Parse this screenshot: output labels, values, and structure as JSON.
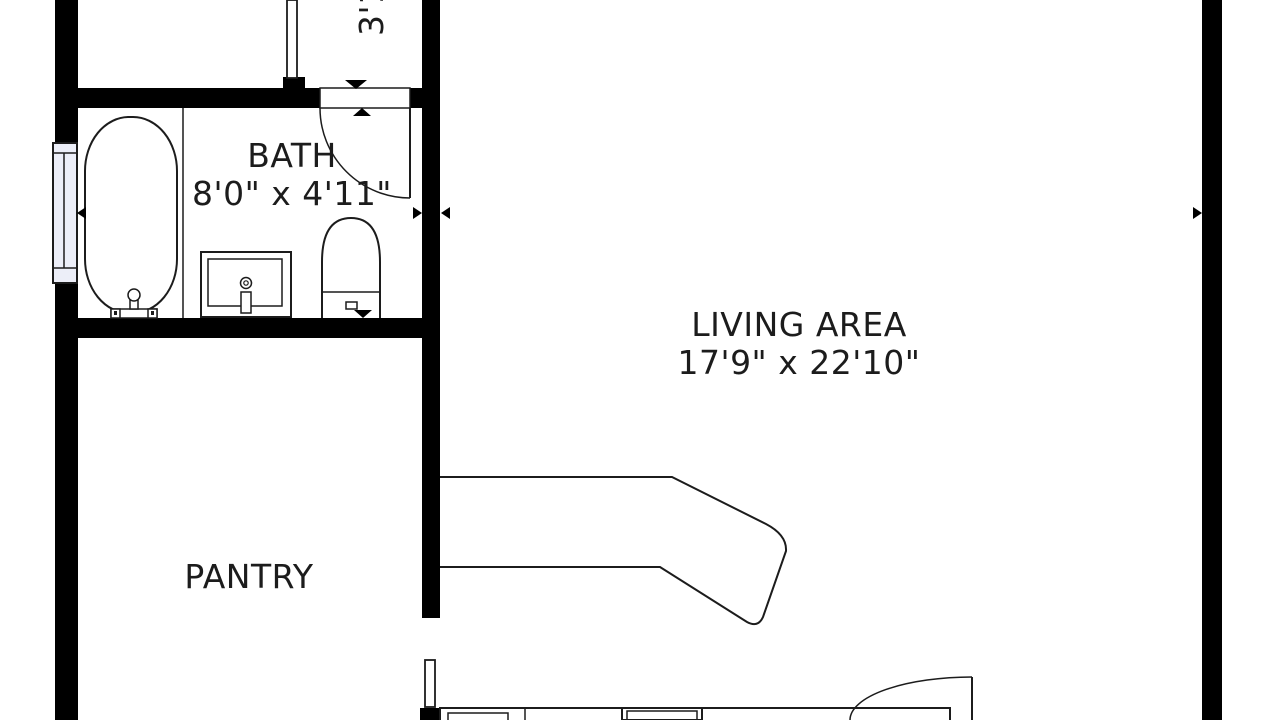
{
  "colors": {
    "wall": "#000000",
    "line": "#1c1c1c",
    "text": "#1c1c1c",
    "background": "#ffffff",
    "window_fill": "#eceef8"
  },
  "rooms": [
    {
      "id": "bath",
      "name": "BATH",
      "dimensions": "8'0\" x 4'11\""
    },
    {
      "id": "living-area",
      "name": "LIVING AREA",
      "dimensions": "17'9\" x 22'10\""
    },
    {
      "id": "pantry",
      "name": "PANTRY",
      "dimensions": ""
    },
    {
      "id": "hallway",
      "name": "",
      "dimensions": "3'1"
    }
  ],
  "fixtures": [
    "bathtub",
    "tub-faucet",
    "vanity-sink",
    "sink-faucet",
    "toilet",
    "bath-window",
    "bath-door",
    "hall-door",
    "pantry-door",
    "entry-door",
    "sectional-sofa",
    "kitchen-counter",
    "stove"
  ]
}
